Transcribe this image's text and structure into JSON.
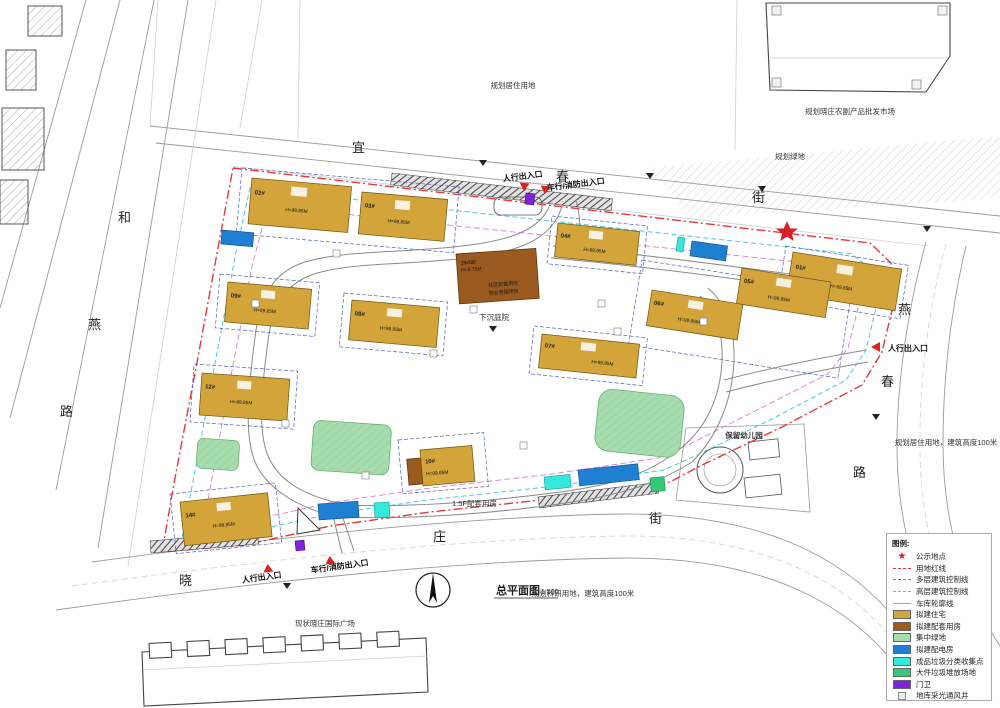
{
  "title": {
    "name": "总平面图",
    "scale": "1:500"
  },
  "streets": {
    "top": [
      "宜",
      "春",
      "街"
    ],
    "left": [
      "和",
      "燕",
      "路"
    ],
    "right": [
      "燕",
      "春",
      "路"
    ],
    "bottom": [
      "晓",
      "庄",
      "街"
    ]
  },
  "entrances": {
    "pedestrian": "人行出入口",
    "vehicle": "车行/消防出入口"
  },
  "context": {
    "top_center": "规划居住用地",
    "top_right": "规划晓庄农副产品批发市场",
    "green_strip": "规划绿地",
    "kindergarten": "保留幼儿园",
    "right_parcel": "规划居住用地，建筑高度100米",
    "bottom_right": "规划科研用地，建筑高度100米",
    "bottom_left": "现状晓庄国际广场",
    "sunken": "下沉庭院",
    "annex": "1.5F配套用房"
  },
  "buildings": [
    {
      "num": "02#",
      "h": "H=99.85M"
    },
    {
      "num": "03#",
      "h": "H=99.85M"
    },
    {
      "num": "04#",
      "h": "H=99.85M"
    },
    {
      "num": "01#",
      "h": "H=99.85M"
    },
    {
      "num": "05#",
      "h": "H=99.85M"
    },
    {
      "num": "06#",
      "h": "H=99.85M"
    },
    {
      "num": "07#",
      "h": "H=99.85M"
    },
    {
      "num": "08#",
      "h": "H=99.85M"
    },
    {
      "num": "09#",
      "h": "H=99.85M"
    },
    {
      "num": "12#",
      "h": "H=99.85M"
    },
    {
      "num": "14#",
      "h": "H=99.85M"
    },
    {
      "num": "10#",
      "h": "H=99.85M"
    }
  ],
  "center_building": {
    "num": "15#/2F",
    "h": "H=9.75M",
    "line1": "社区配套用房",
    "line2": "物业管理用房"
  },
  "legend": {
    "title": "图例:",
    "items": [
      {
        "icon": "star-icon",
        "label": "公示地点"
      },
      {
        "icon": "red-dash-line",
        "label": "用地红线"
      },
      {
        "icon": "multi-dash-line",
        "label": "多层建筑控制线"
      },
      {
        "icon": "highrise-dash-line",
        "label": "高层建筑控制线"
      },
      {
        "icon": "garage-outline-line",
        "label": "车库轮廓线"
      },
      {
        "icon": "swatch-residential",
        "label": "拟建住宅"
      },
      {
        "icon": "swatch-support",
        "label": "拟建配套用房"
      },
      {
        "icon": "swatch-green",
        "label": "集中绿地"
      },
      {
        "icon": "swatch-power",
        "label": "拟建配电房"
      },
      {
        "icon": "swatch-recycle",
        "label": "成品垃圾分类收集点"
      },
      {
        "icon": "swatch-bulky",
        "label": "大件垃圾堆放场地"
      },
      {
        "icon": "swatch-gate",
        "label": "门卫"
      },
      {
        "icon": "vent-square",
        "label": "地库采光通风井"
      }
    ]
  },
  "colors": {
    "redline": "#e03a3a",
    "control": "#4a62c8",
    "multi": "#7a8699",
    "highrise": "#e07ad0",
    "garage": "#49c8d8",
    "residential": "#d2a43a",
    "support": "#9a5a20",
    "green_area": "#a6dcae",
    "power": "#1f7fd0",
    "recycle": "#35e8dc",
    "bulky": "#35c878",
    "gate": "#7e22dd",
    "star": "#d81e2c",
    "arrow": "#e01f1f"
  }
}
